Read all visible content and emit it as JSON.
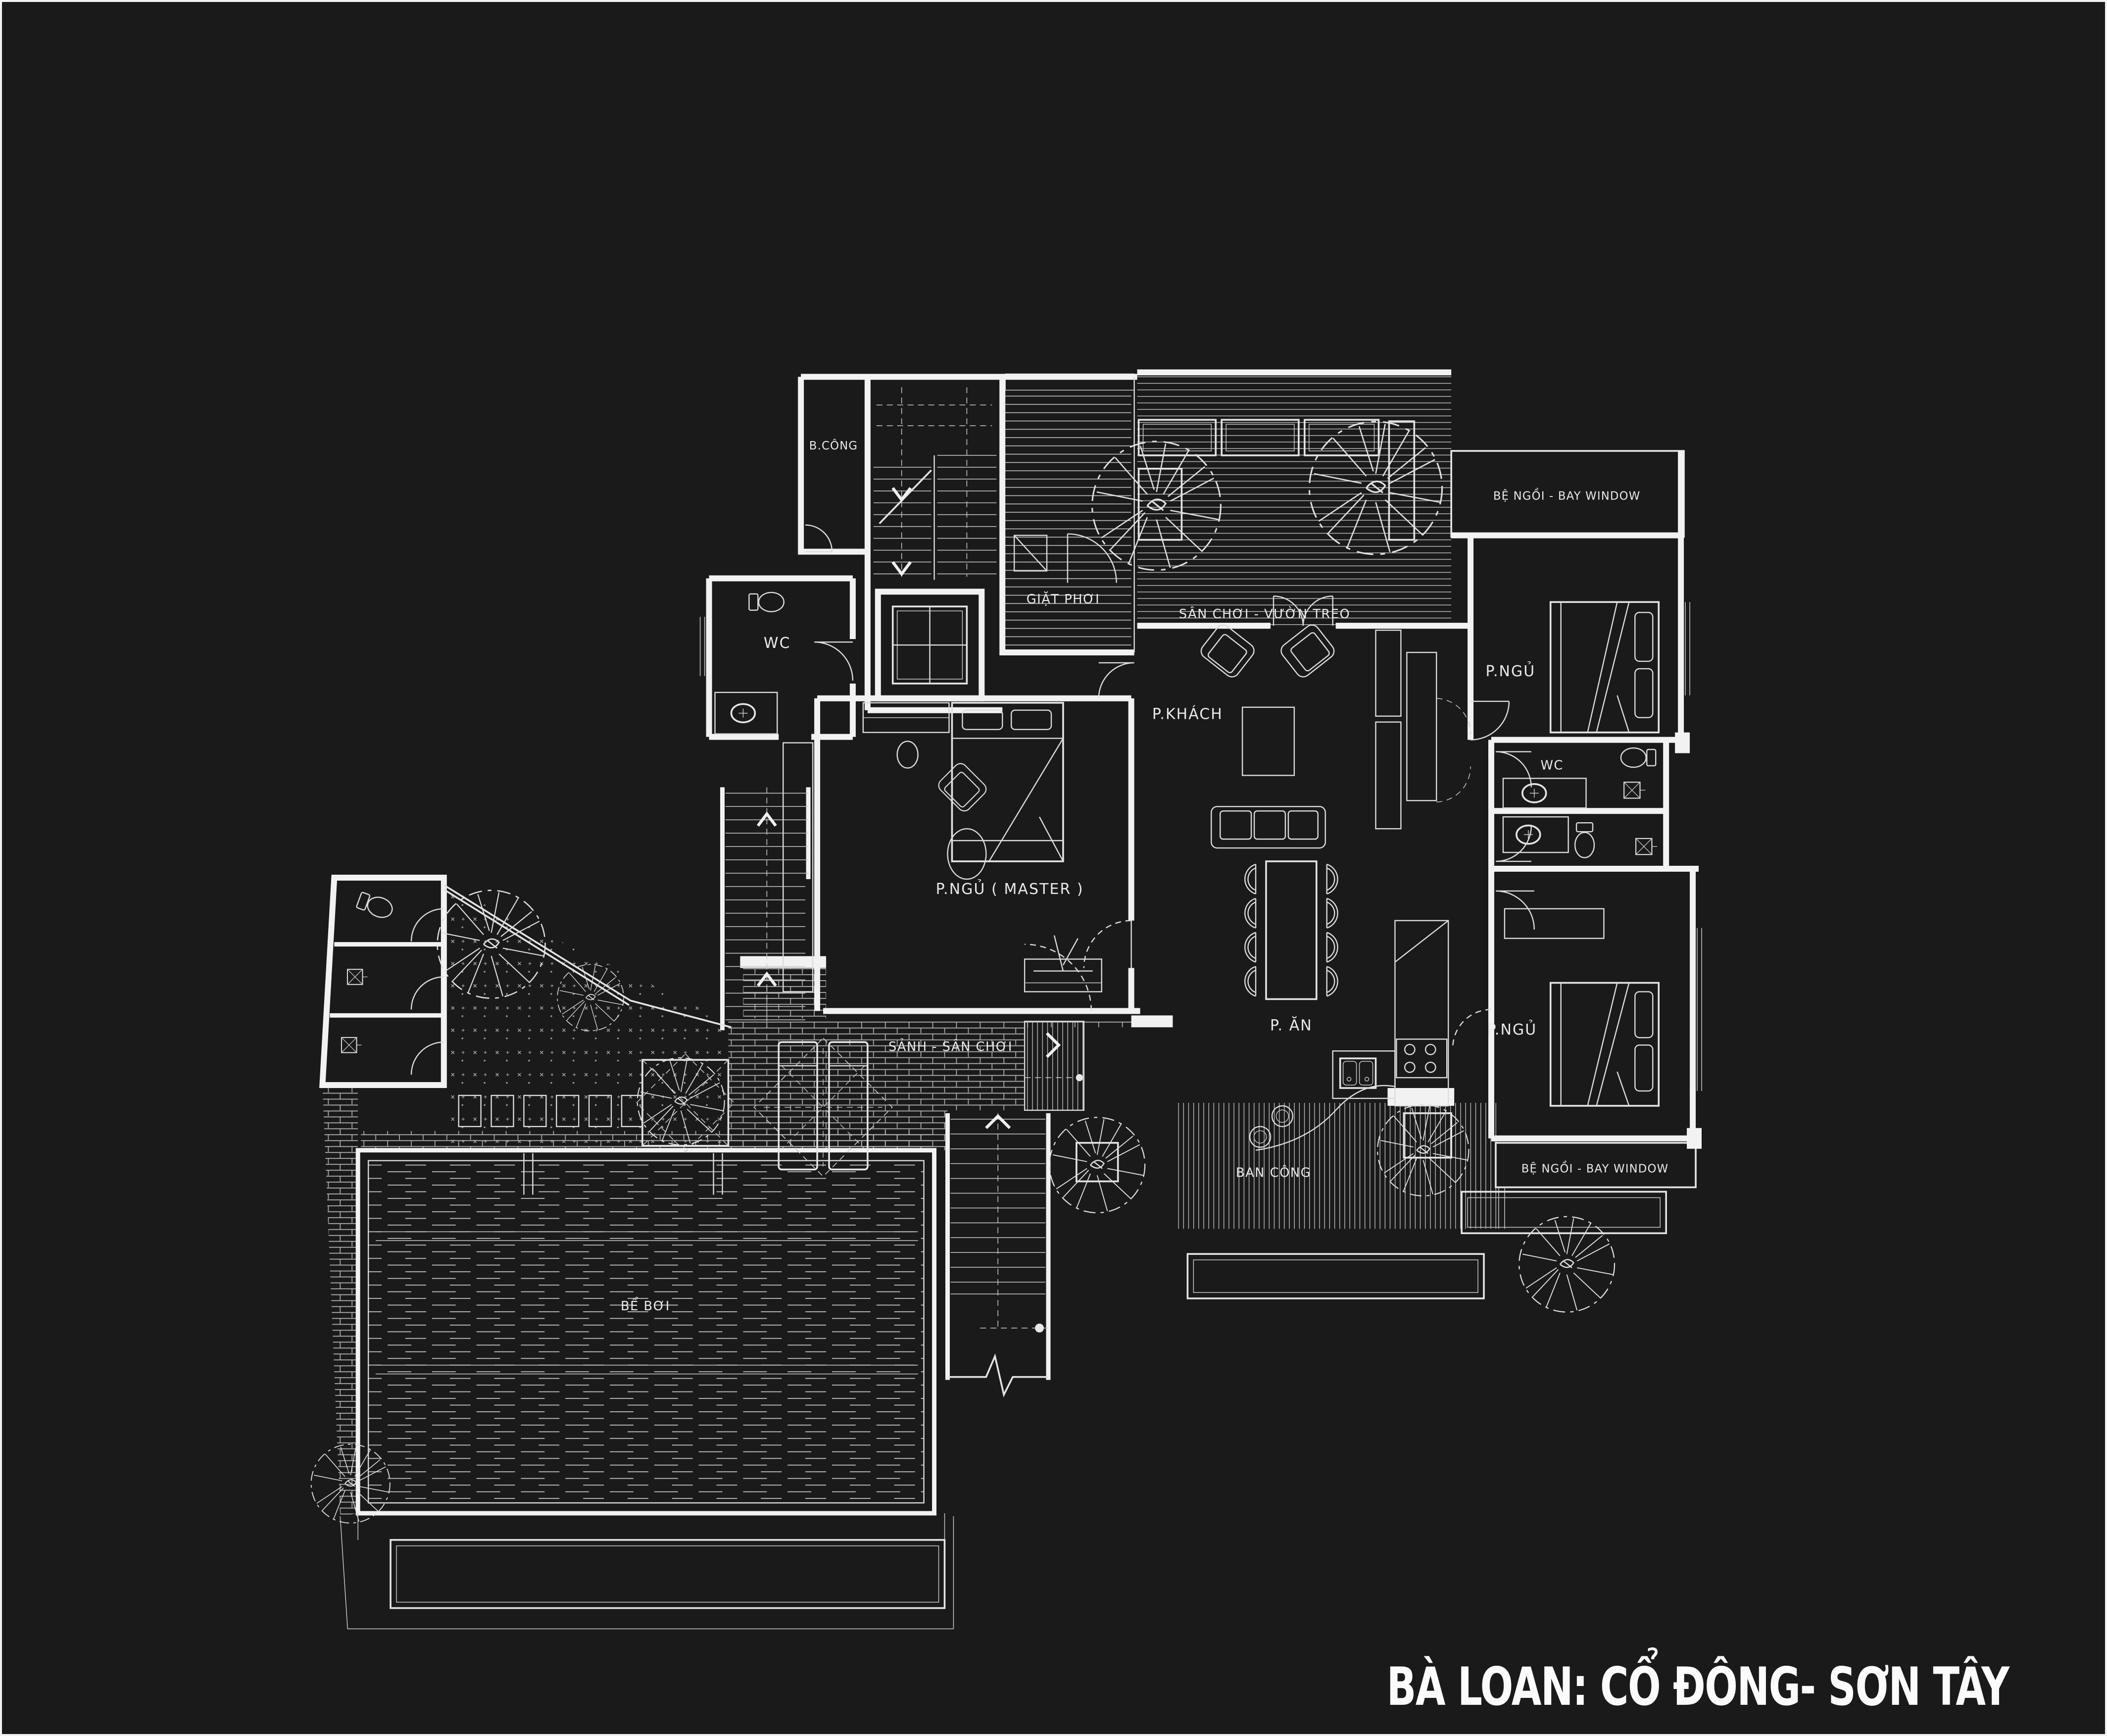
{
  "title": "BÀ LOAN: CỔ ĐÔNG- SƠN TÂY",
  "palette": {
    "background": "#1a1a1a",
    "line": "#f2f2f2"
  },
  "rooms": {
    "bcong": "B.CÔNG",
    "giat_phoi": "GIẶT  PHƠI",
    "san_choi": "SÂN CHƠI - VƯỜN TREO",
    "bay_top": "BỆ NGỒI - BAY WINDOW",
    "pngu_top": "P.NGỦ",
    "wc_left": "WC",
    "pkhach": "P.KHÁCH",
    "wc_right": "WC",
    "master": "P.NGỦ ( MASTER )",
    "pan": "P. ĂN",
    "sanh": "SẢNH - SÂN CHƠI",
    "pngu_bottom": "P.NGỦ",
    "beboi": "BỂ BƠI",
    "bancong": "BAN CÔNG",
    "bay_bottom": "BỆ NGỒI - BAY WINDOW"
  }
}
